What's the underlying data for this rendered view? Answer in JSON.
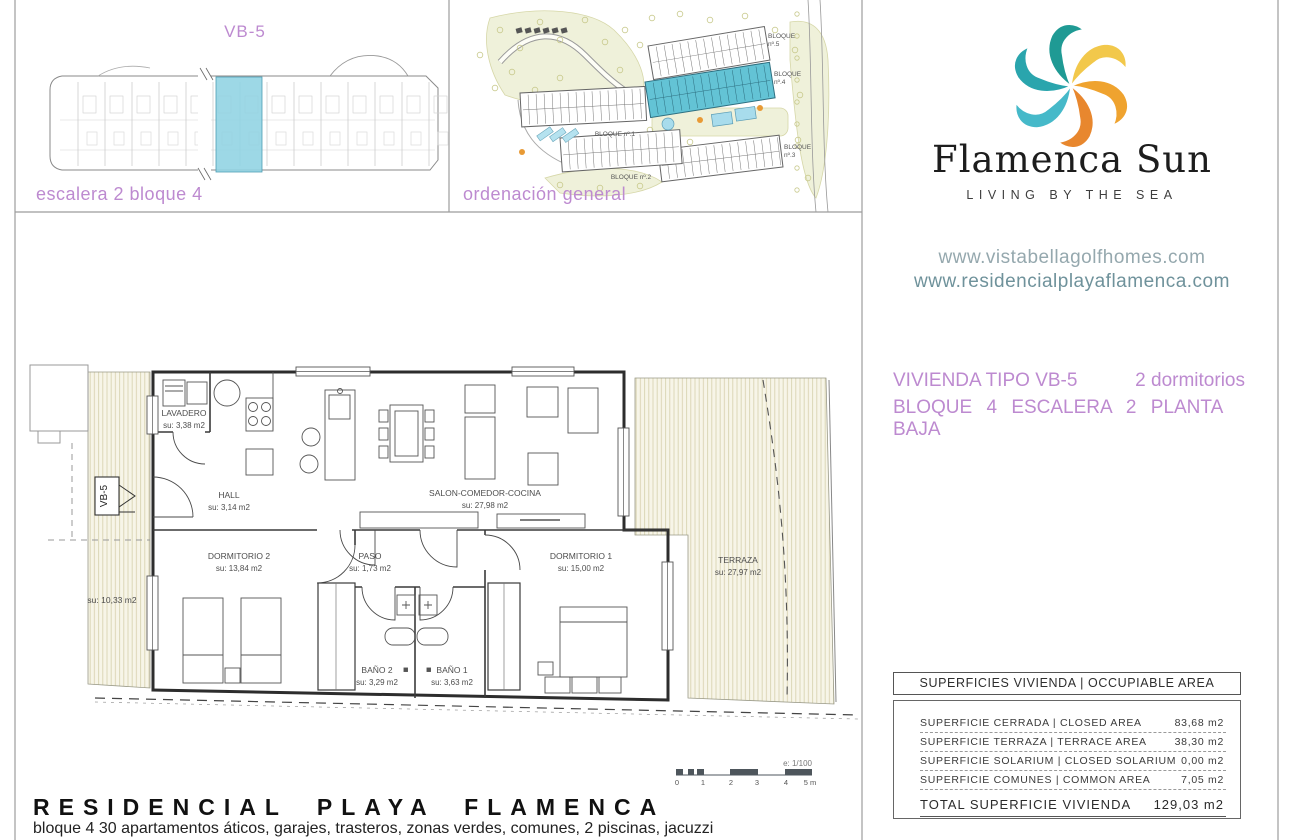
{
  "top_left_panel": {
    "title": "VB-5",
    "caption": "escalera 2 bloque 4"
  },
  "site_panel": {
    "caption": "ordenación general",
    "blocks": {
      "b5a": "BLOQUE",
      "b5b": "nº.5",
      "b4a": "BLOQUE",
      "b4b": "nº.4",
      "b3a": "BLOQUE",
      "b3b": "nº.3",
      "b2": "BLOQUE nº.2",
      "b1": "BLOQUE nº.1"
    }
  },
  "brand": {
    "name": "Flamenca Sun",
    "tagline": "LIVING BY THE SEA",
    "website1": "www.vistabellagolfhomes.com",
    "website2": "www.residencialplayaflamenca.com",
    "logo_colors": [
      "#f2c84b",
      "#efa32f",
      "#e8872e",
      "#46b9c9",
      "#2aa5ad",
      "#1f9a94"
    ],
    "accent_purple": "#bd8ad0"
  },
  "unit_info": {
    "type_label": "VIVIENDA TIPO VB-5",
    "bedrooms": "2 dormitorios",
    "location": "BLOQUE 4 ESCALERA 2 PLANTA BAJA"
  },
  "areas_table": {
    "header": "SUPERFICIES VIVIENDA | OCCUPIABLE AREA",
    "rows": [
      {
        "label": "SUPERFICIE CERRADA | CLOSED AREA",
        "value": "83,68 m2"
      },
      {
        "label": "SUPERFICIE TERRAZA   | TERRACE AREA",
        "value": "38,30 m2"
      },
      {
        "label": "SUPERFICIE SOLARIUM | CLOSED SOLARIUM",
        "value": "0,00 m2"
      },
      {
        "label": "SUPERFICIE COMUNES | COMMON AREA",
        "value": "7,05 m2"
      }
    ],
    "total_label": "TOTAL SUPERFICIE VIVIENDA",
    "total_value": "129,03 m2"
  },
  "floor_plan": {
    "marker": "VB-5",
    "side_area": "su: 10,33 m2",
    "rooms": [
      {
        "name": "LAVADERO",
        "area": "su: 3,38 m2"
      },
      {
        "name": "HALL",
        "area": "su: 3,14 m2"
      },
      {
        "name": "SALON-COMEDOR-COCINA",
        "area": "su: 27,98 m2"
      },
      {
        "name": "DORMITORIO 2",
        "area": "su: 13,84 m2"
      },
      {
        "name": "PASO",
        "area": "su: 1,73 m2"
      },
      {
        "name": "DORMITORIO 1",
        "area": "su: 15,00 m2"
      },
      {
        "name": "BAÑO 2",
        "area": "su: 3,29 m2"
      },
      {
        "name": "BAÑO 1",
        "area": "su: 3,63 m2"
      },
      {
        "name": "TERRAZA",
        "area": "su: 27,97 m2"
      }
    ],
    "scale": {
      "label": "e: 1/100",
      "ticks": [
        "0",
        "1",
        "2",
        "3",
        "4",
        "5 m"
      ]
    }
  },
  "footer": {
    "title": "RESIDENCIAL PLAYA FLAMENCA",
    "subtitle": "bloque 4 30 apartamentos áticos, garajes, trasteros, zonas verdes, comunes, 2 piscinas, jacuzzi"
  }
}
